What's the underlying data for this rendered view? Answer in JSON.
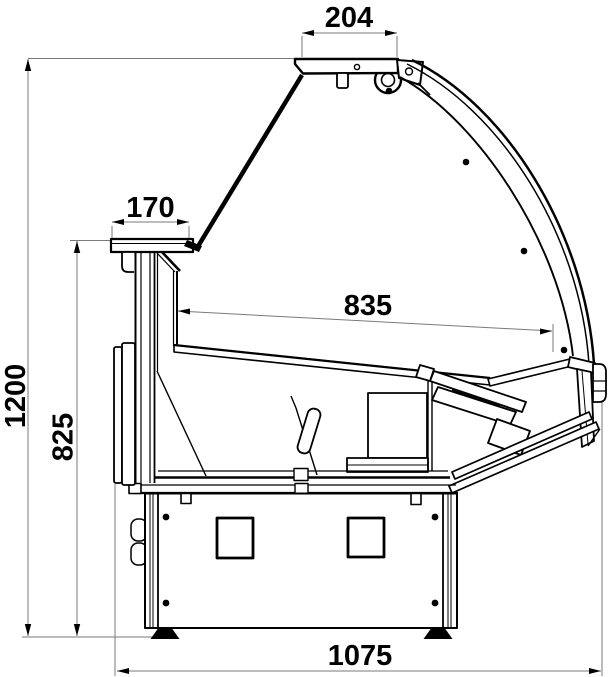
{
  "diagram": {
    "dimensions": {
      "canopy_depth": "204",
      "worktop_depth": "170",
      "deck_depth": "835",
      "overall_height": "1200",
      "worktop_height": "825",
      "overall_depth": "1075"
    },
    "colors": {
      "line": "#000000",
      "dimension_line": "#7a7a7a",
      "background": "#ffffff"
    }
  }
}
